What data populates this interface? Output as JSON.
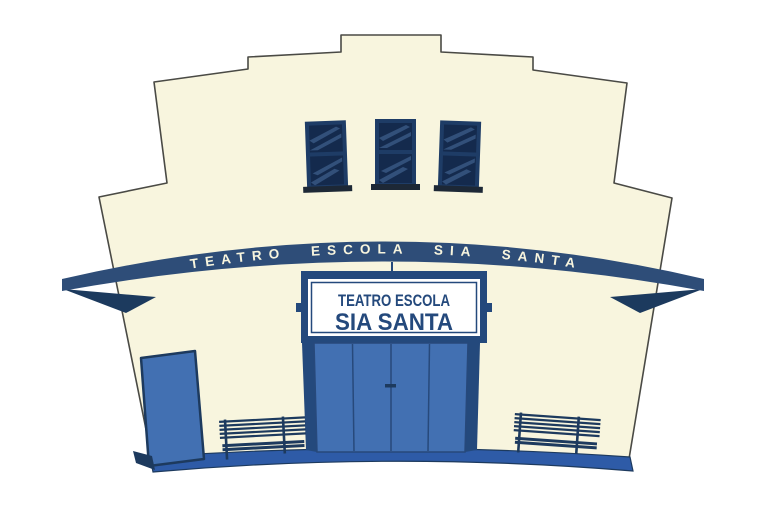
{
  "scene": {
    "arch_banner": {
      "text": "TEATRO ESCOLA SIA SANTA"
    },
    "marquee_sign": {
      "line1": "TEATRO ESCOLA",
      "line2": "SIA SANTA"
    },
    "colors": {
      "facade": "#F8F5DE",
      "outline": "#4A4A45",
      "awning": "#2E4D78",
      "awning_underside": "#1C3A5E",
      "cream_text": "#F8F5DE",
      "navy_dark": "#24497C",
      "sign_white": "#FFFFFF",
      "window_pane": "#142A4D",
      "window_frame": "#1E3C66",
      "window_streak": "#32507A",
      "sill": "#1D2836",
      "door_blue": "#4270B2",
      "door_seam": "#27497B",
      "door_outline": "#1D3A5E",
      "base_strip": "#2E5BA7",
      "bench": "#1D3A5E"
    }
  }
}
